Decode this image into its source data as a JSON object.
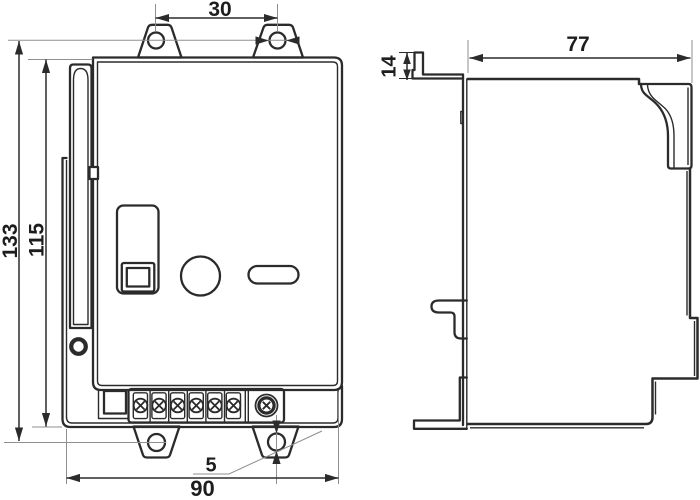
{
  "drawing": {
    "type": "technical-dimension-drawing",
    "background": "#ffffff",
    "line_color": "#2b2b2b",
    "construction_line_color": "#8f8f8f",
    "views": {
      "front": "front-view",
      "side": "side-view"
    },
    "dimensions": {
      "top_tab_hole_spacing": "30",
      "depth": "77",
      "rail_tab_height": "14",
      "mounting_hole_span": "133",
      "body_height": "115",
      "tab_hole_diameter": "5",
      "body_width": "90"
    }
  }
}
